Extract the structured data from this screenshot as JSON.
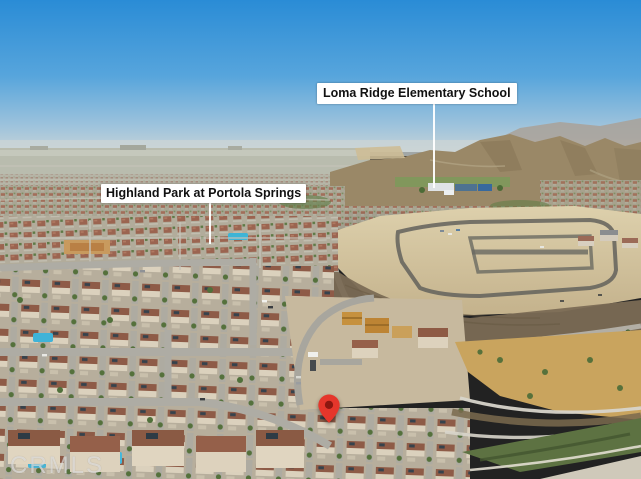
{
  "photo": {
    "labels": {
      "school": "Loma Ridge Elementary School",
      "neighborhood": "Highland Park at Portola Springs"
    },
    "marker": {
      "icon": "location-pin-icon",
      "color": "#e5362b"
    },
    "watermark": "CRMLS",
    "colors": {
      "sky_top": "#2a8cd6",
      "sky_horizon": "#c7d4d8",
      "label_bg": "#ffffff",
      "label_text": "#111111",
      "leader_line": "#ffffff",
      "dirt_lot": "#d1c09a",
      "mountains": "#9a8867",
      "roof_red": "#8e5b47",
      "field_gold": "#c9a45e",
      "pin_red": "#e5362b",
      "watermark_color": "rgba(255,255,255,0.55)"
    }
  }
}
